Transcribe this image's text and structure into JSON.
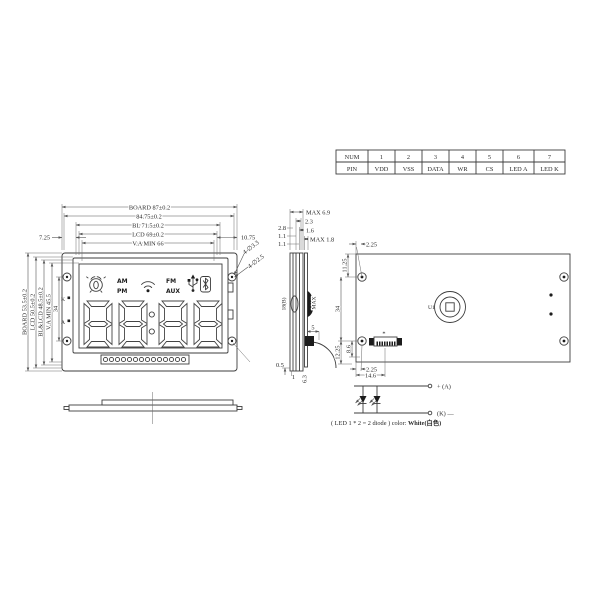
{
  "pin_table": {
    "rows": [
      {
        "label": "NUM",
        "cells": [
          "1",
          "2",
          "3",
          "4",
          "5",
          "6",
          "7"
        ]
      },
      {
        "label": "PIN",
        "cells": [
          "VDD",
          "VSS",
          "DATA",
          "WR",
          "CS",
          "LED A",
          "LED K"
        ]
      }
    ]
  },
  "front_view": {
    "top_dims": [
      "BOARD 87±0.2",
      "84.75±0.2",
      "BL 71.5±0.2",
      "LCD 69±0.2",
      "V.A MIN 66"
    ],
    "left_offset": "7.25",
    "right_offset": "10.75",
    "side_dims": [
      "BOARD 53.5±0.2",
      "LCD 50.5±0.2",
      "BL&LCD 48.5±0.2",
      "V.A MIN 45.5",
      "34"
    ],
    "hole_notes": [
      "4-∅3.3",
      "4-∅2.5"
    ],
    "terminal_top": "K",
    "terminal_bottom": "A",
    "labels": {
      "am": "AM",
      "pm": "PM",
      "fm": "FM",
      "aux": "AUX"
    }
  },
  "section_view": {
    "top_dims": [
      "MAX 6.9",
      "2.3",
      "1.6",
      "MAX 1.8"
    ],
    "left_dims": [
      "2.8",
      "1.1",
      "1.1"
    ],
    "side_label_left": "18(B)",
    "side_label_right": "MAX",
    "dim_gap": "0.5",
    "dim_pin": "1",
    "dim_depth": "6.3",
    "dim_comp": "5"
  },
  "back_view": {
    "component_ref": "U1",
    "pin1_mark": "*",
    "dim_top_offset": "2.25",
    "dim_hole_top": "11.25",
    "dim_hole_span": "34",
    "dim_hole_bottom": "12.25",
    "dim_conn_height": "8.6",
    "dim_bottom_offset": "2.25",
    "dim_conn_width": "14.6"
  },
  "led_circuit": {
    "anode_label": "+ (A)",
    "cathode_label": "(K) —",
    "caption_prefix": "( LED 1 * 2 = 2 diode ) color: ",
    "caption_value": "White(白色)"
  }
}
